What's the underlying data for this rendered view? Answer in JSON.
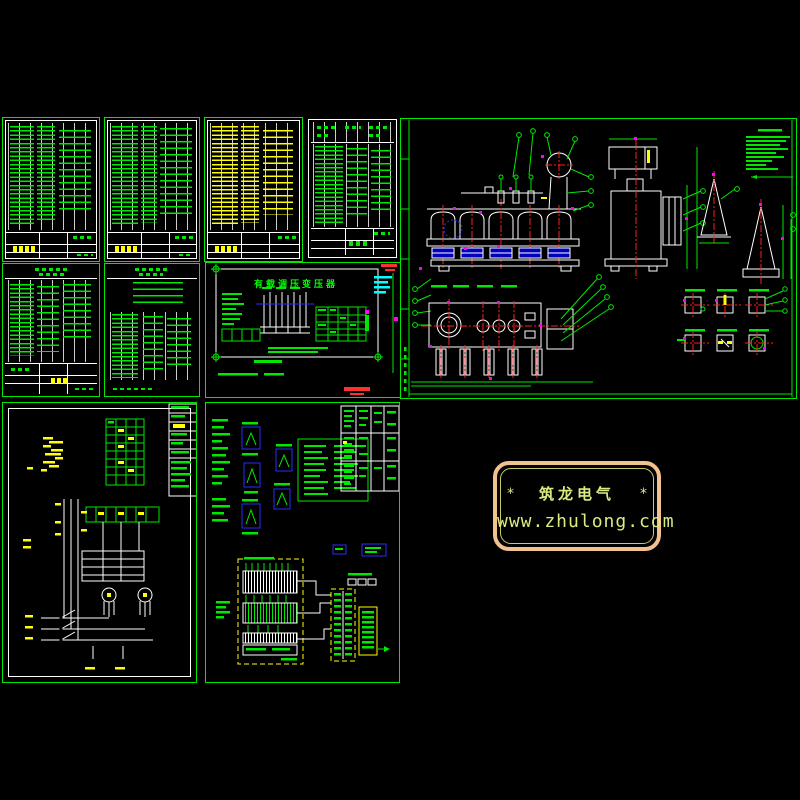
{
  "watermark": {
    "star_left": "*",
    "brand": "筑龙电气",
    "star_right": "*",
    "url": "www.zhulong.com"
  },
  "tap_changer_panel": {
    "title": "有载调压变压器"
  },
  "colors": {
    "line_green": "#00E800",
    "highlight_yellow": "#FFFF00",
    "drawing_white": "#FFFFFF",
    "centerline_red": "#FF2020",
    "mark_magenta": "#FF00FF",
    "aux_cyan": "#00FFFF",
    "symbol_blue": "#2B2BFF",
    "watermark_border": "#F2C18F",
    "watermark_text": "#D9EC80"
  }
}
